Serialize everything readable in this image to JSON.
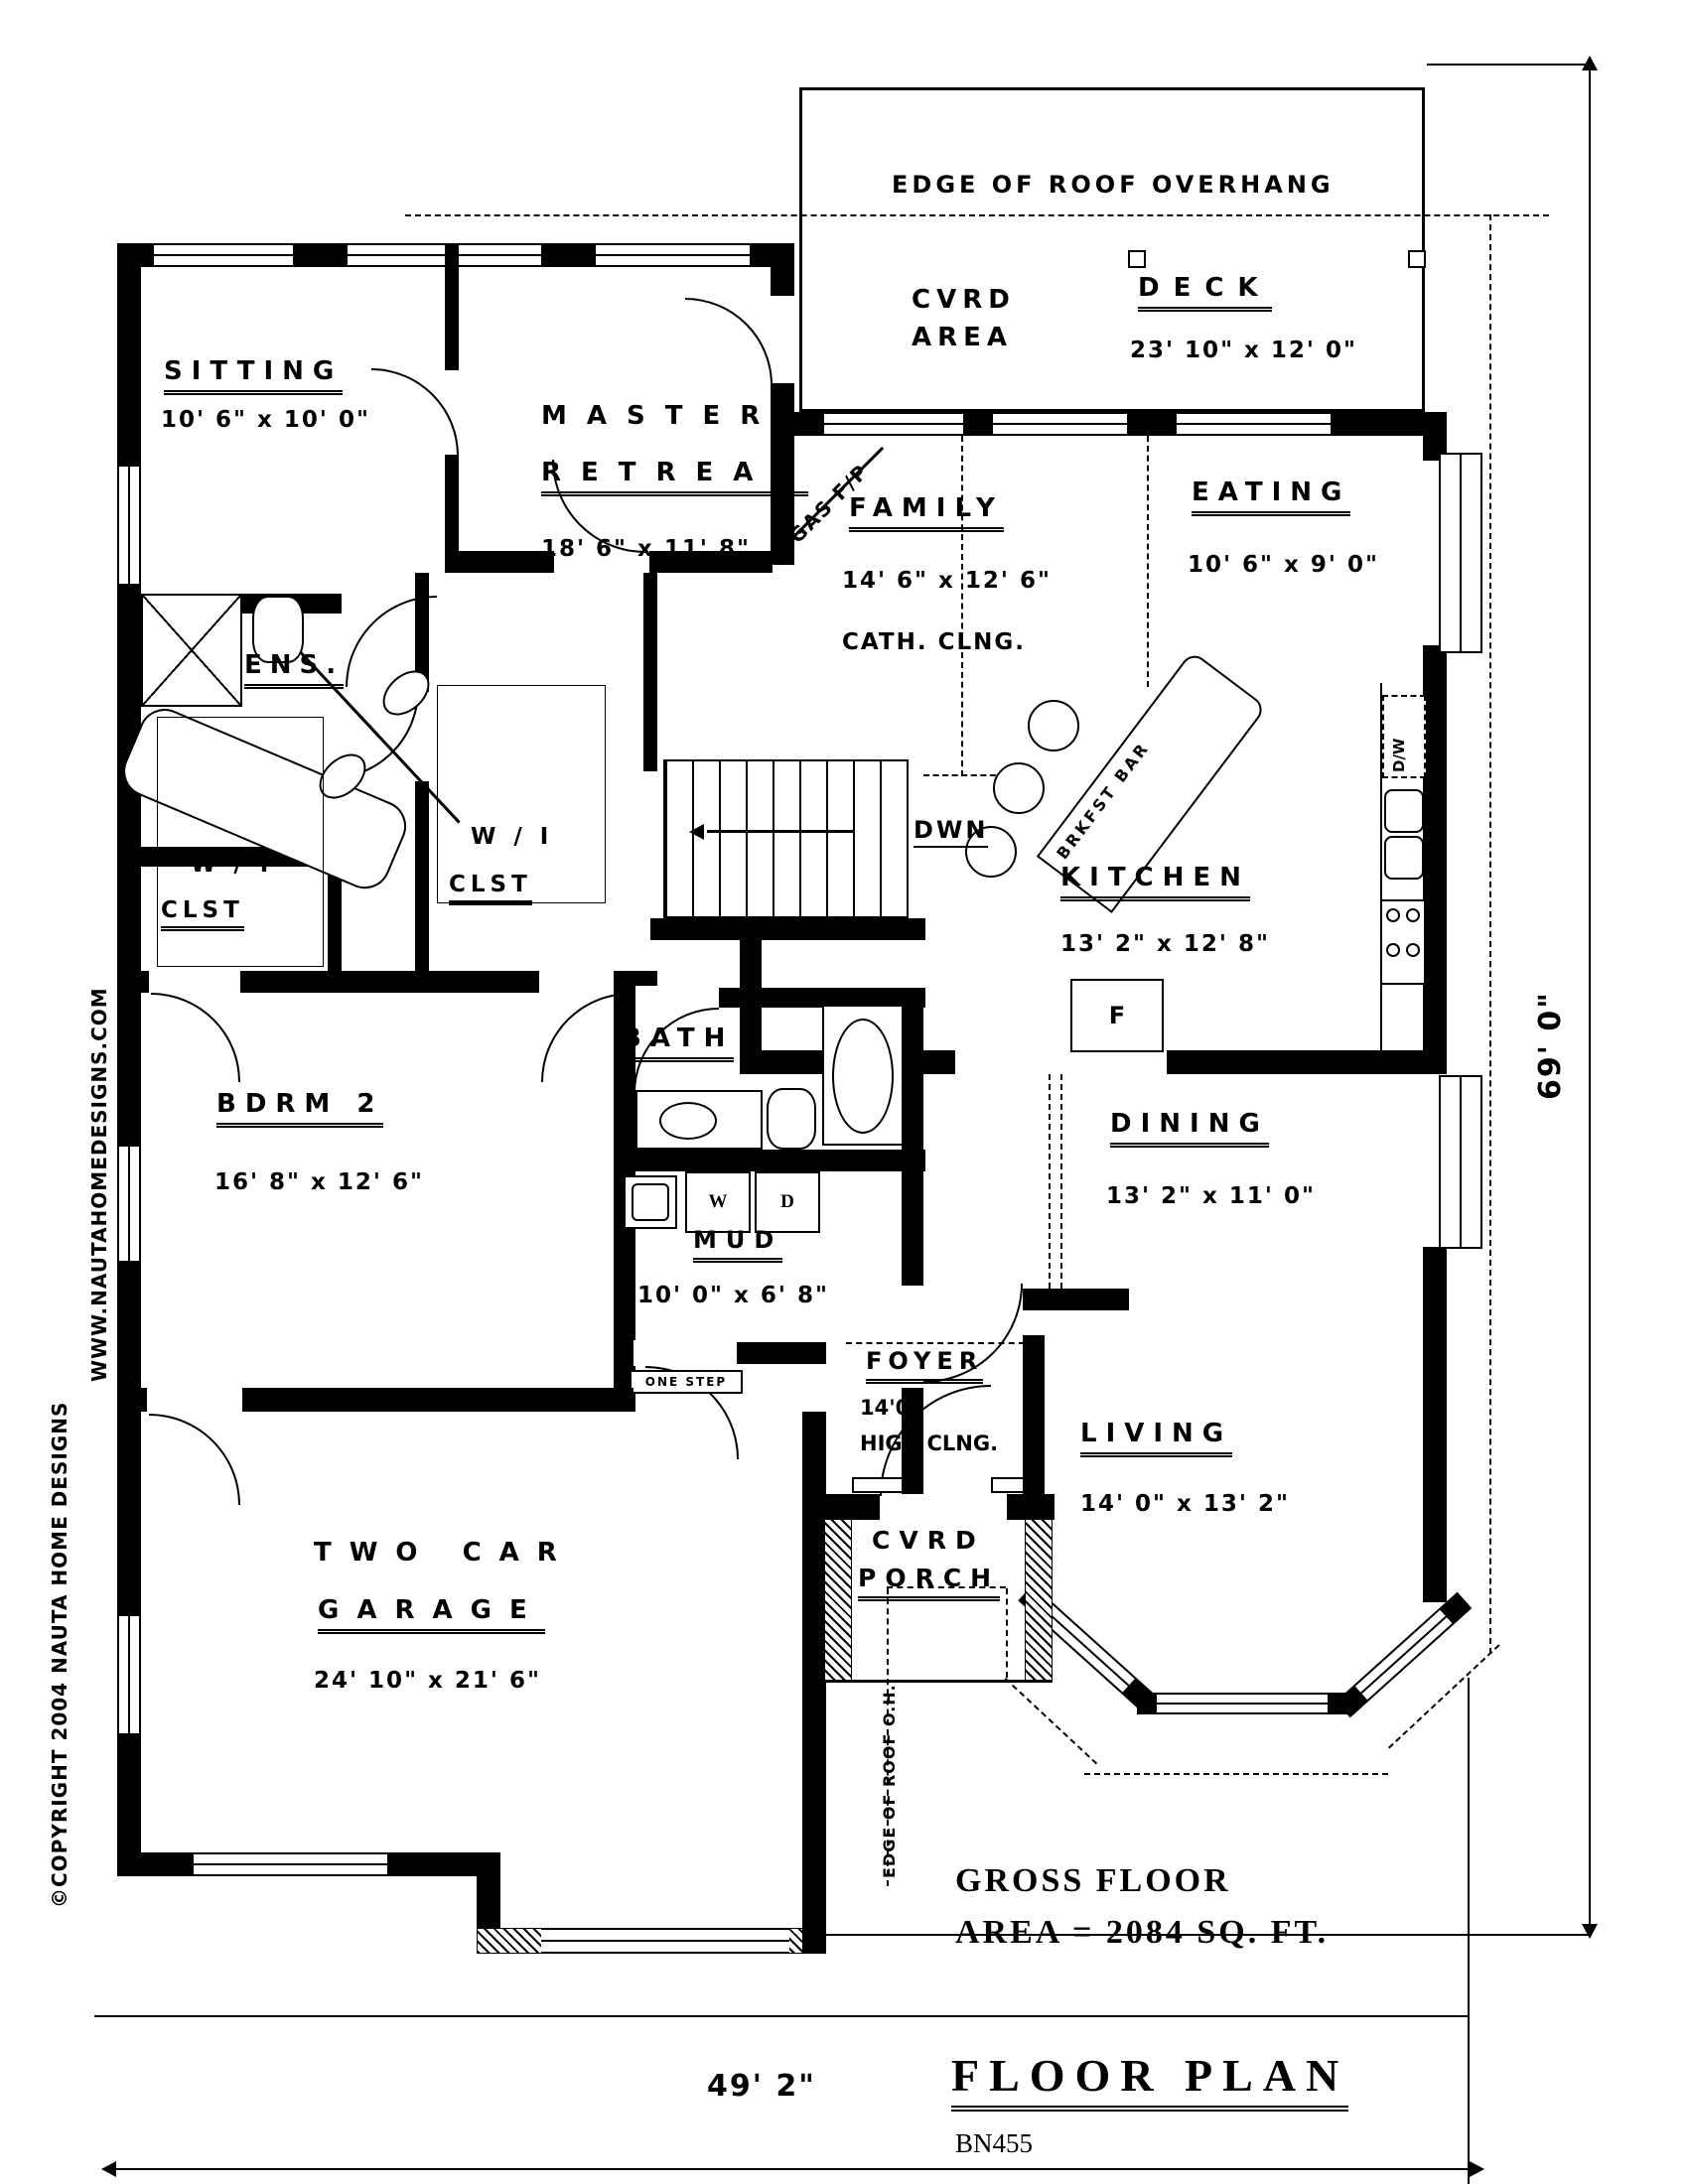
{
  "branding": {
    "website": "WWW.NAUTAHOMEDESIGNS.COM",
    "copyright": "©COPYRIGHT 2004 NAUTA HOME DESIGNS"
  },
  "titleblock": {
    "title": "FLOOR PLAN",
    "plan_no": "BN455",
    "area_line1": "GROSS FLOOR",
    "area_line2": "AREA = 2084 SQ. FT."
  },
  "overall_dims": {
    "width": "49' 2\"",
    "height": "69' 0\""
  },
  "annotations": {
    "roof_top": "EDGE OF ROOF OVERHANG",
    "roof_bottom": "EDGE OF ROOF O.H.",
    "gas_fp": "GAS F/P",
    "down": "DWN",
    "brkfst": "BRKFST BAR",
    "one_step": "ONE STEP",
    "dw": "D/W",
    "fridge": "F",
    "washer": "W",
    "dryer": "D",
    "cath": "CATH. CLNG.",
    "foyer_height": "14'0\"",
    "foyer_note": "HIGH CLNG."
  },
  "rooms": {
    "sitting": {
      "name": "SITTING",
      "dims": "10' 6\" x 10' 0\""
    },
    "master": {
      "name1": "MASTER",
      "name2": "RETREAT",
      "dims": "18' 6\" x 11' 8\""
    },
    "cvrd_area": {
      "name1": "CVRD",
      "name2": "AREA"
    },
    "deck": {
      "name": "DECK",
      "dims": "23' 10\" x 12' 0\""
    },
    "family": {
      "name": "FAMILY",
      "dims": "14' 6\" x 12' 6\""
    },
    "eating": {
      "name": "EATING",
      "dims": "10' 6\" x 9' 0\""
    },
    "kitchen": {
      "name": "KITCHEN",
      "dims": "13' 2\" x 12' 8\""
    },
    "ens": {
      "name": "ENS."
    },
    "wicl1": {
      "name1": "W / I",
      "name2": "CLST"
    },
    "wicl2": {
      "name1": "W / I",
      "name2": "CLST"
    },
    "bdrm2": {
      "name": "BDRM  2",
      "dims": "16' 8\" x 12' 6\""
    },
    "bath": {
      "name": "BATH"
    },
    "mud": {
      "name": "MUD",
      "dims": "10' 0\" x 6' 8\""
    },
    "dining": {
      "name": "DINING",
      "dims": "13' 2\" x 11' 0\""
    },
    "foyer": {
      "name": "FOYER"
    },
    "living": {
      "name": "LIVING",
      "dims": "14' 0\" x 13' 2\""
    },
    "garage": {
      "name1": "TWO  CAR",
      "name2": "GARAGE",
      "dims": "24' 10\" x 21' 6\""
    },
    "porch": {
      "name1": "CVRD",
      "name2": "PORCH"
    }
  }
}
